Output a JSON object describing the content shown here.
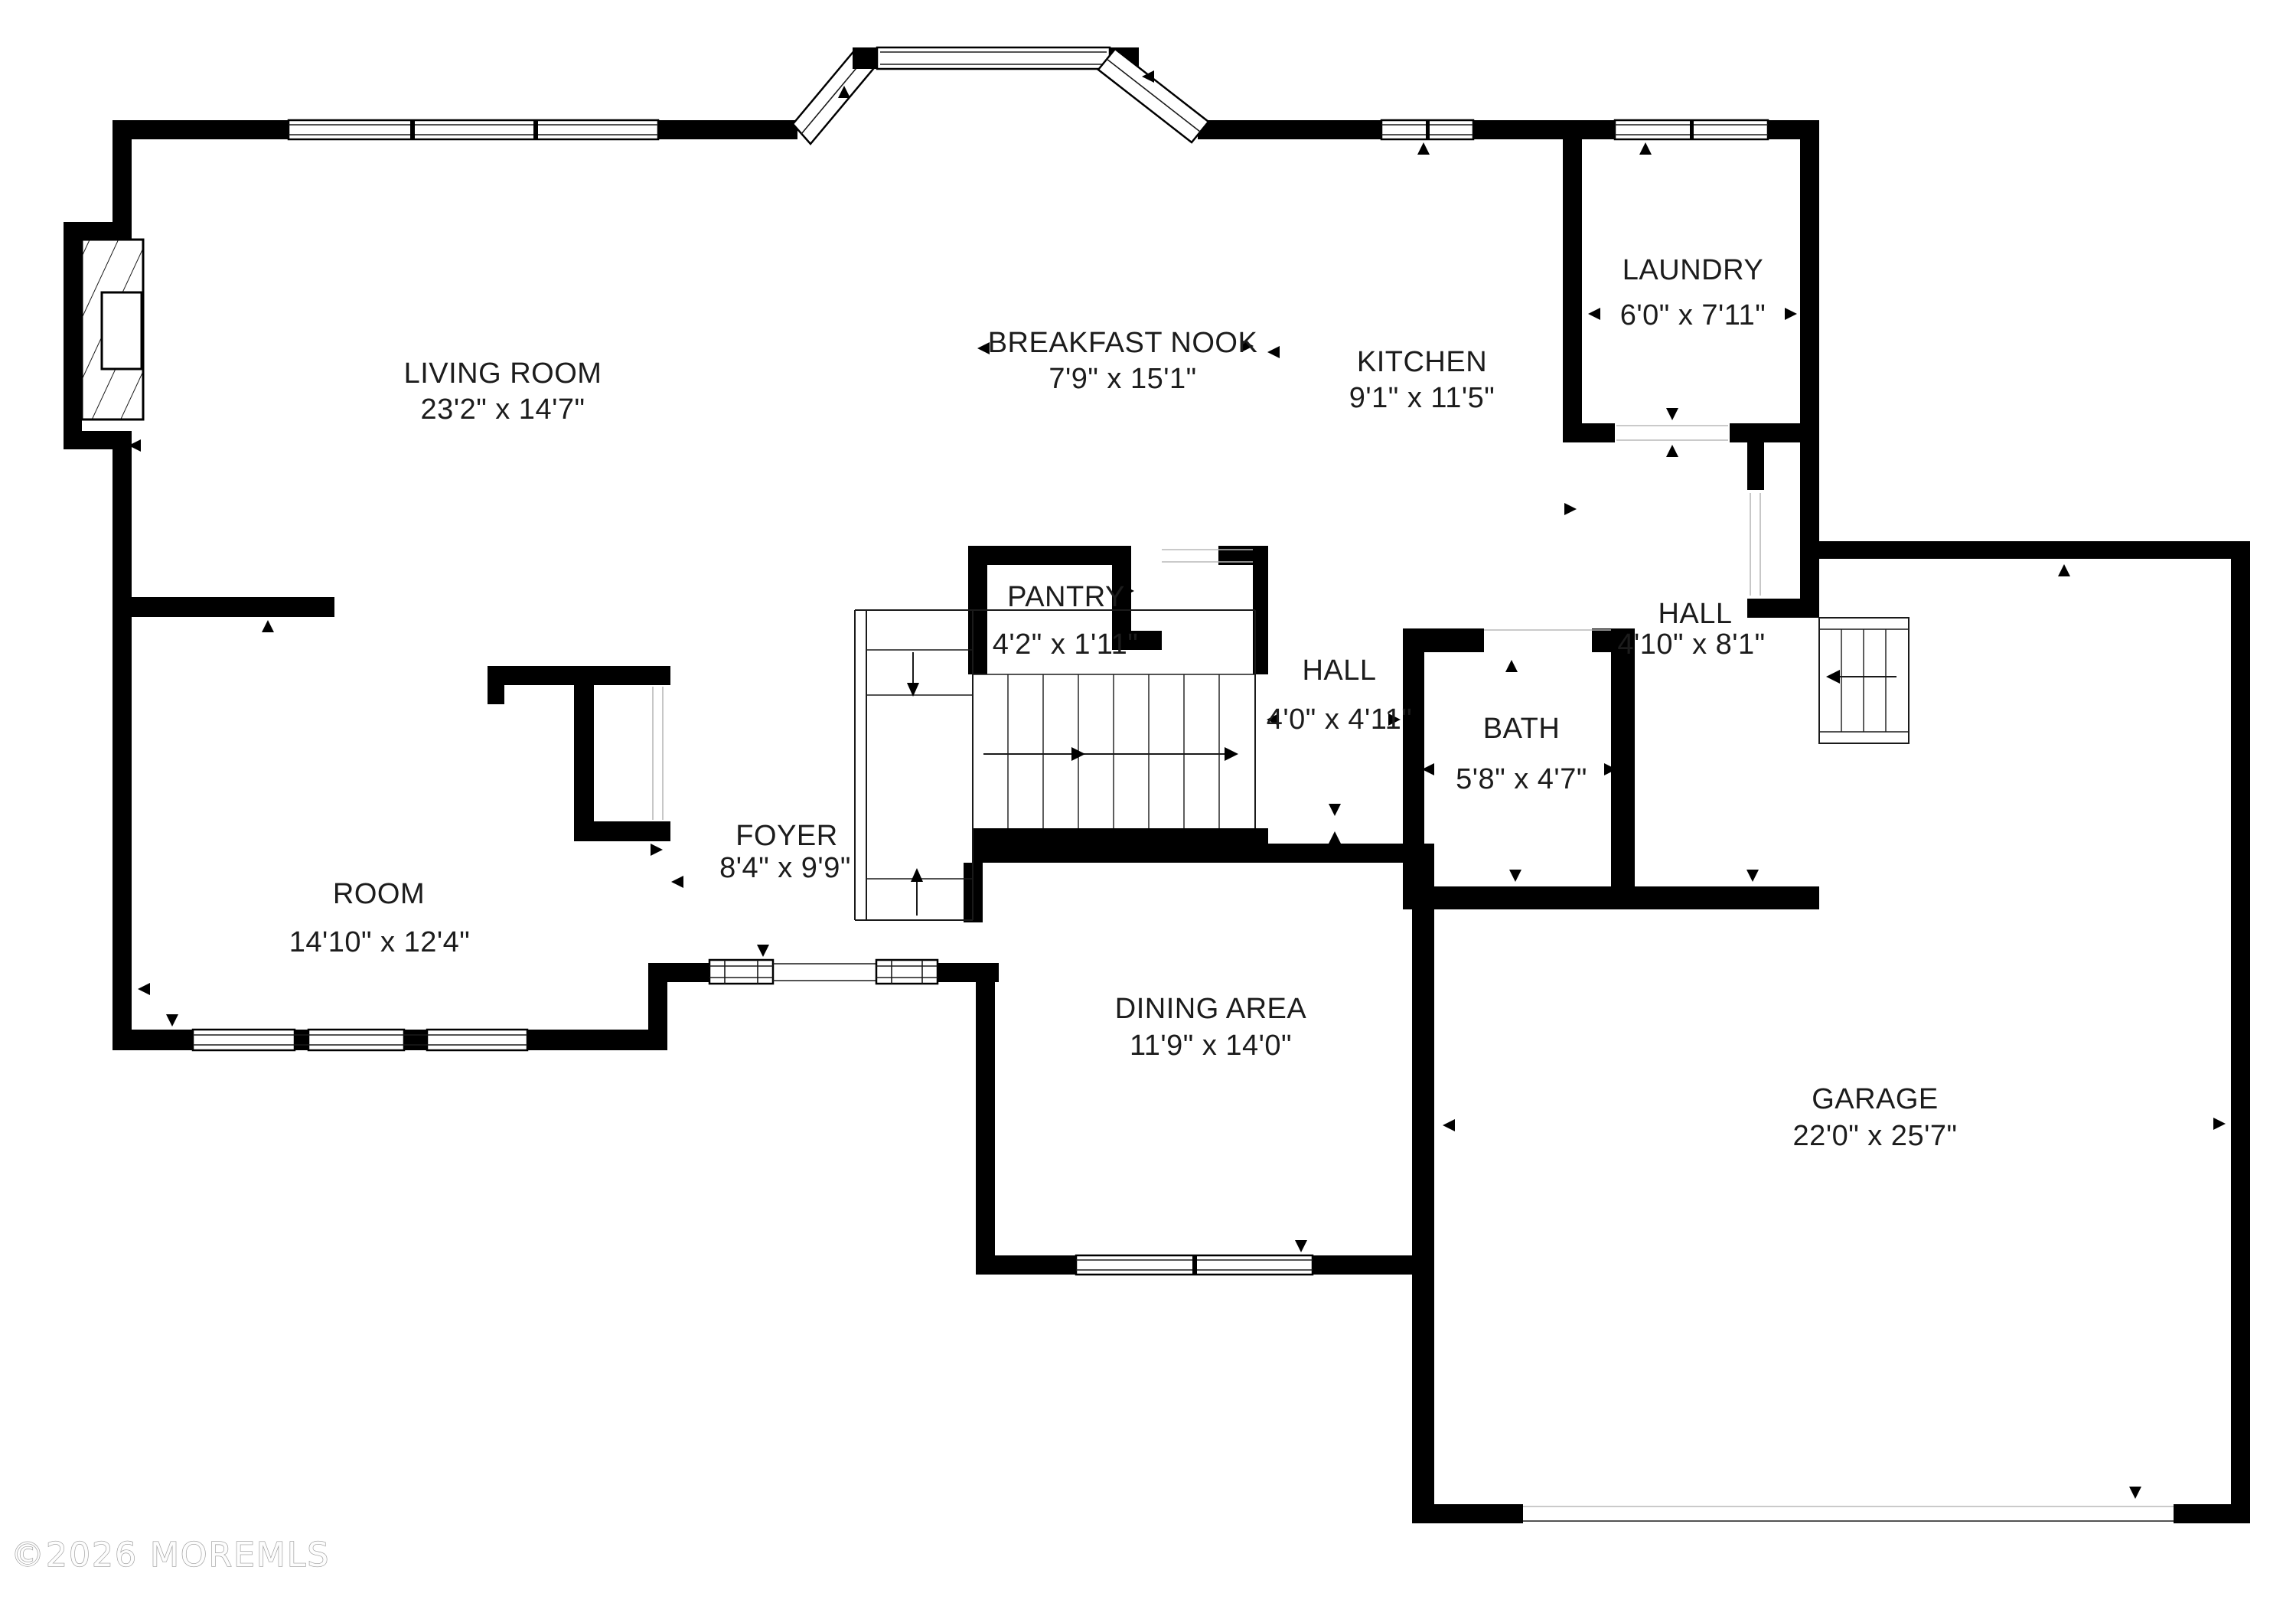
{
  "watermark": "©2026 MOREMLS",
  "rooms": [
    {
      "id": "living-room",
      "name": "LIVING ROOM",
      "dims": "23'2\" x 14'7\""
    },
    {
      "id": "breakfast-nook",
      "name": "BREAKFAST NOOK",
      "dims": "7'9\" x 15'1\""
    },
    {
      "id": "kitchen",
      "name": "KITCHEN",
      "dims": "9'1\" x 11'5\""
    },
    {
      "id": "laundry",
      "name": "LAUNDRY",
      "dims": "6'0\" x 7'11\""
    },
    {
      "id": "pantry",
      "name": "PANTRY",
      "dims": "4'2\" x 1'11\""
    },
    {
      "id": "hall-kitchen",
      "name": "HALL",
      "dims": "4'0\" x 4'11\""
    },
    {
      "id": "bath",
      "name": "BATH",
      "dims": "5'8\" x 4'7\""
    },
    {
      "id": "hall-rear",
      "name": "HALL",
      "dims": "4'10\" x 8'1\""
    },
    {
      "id": "room",
      "name": "ROOM",
      "dims": "14'10\" x 12'4\""
    },
    {
      "id": "foyer",
      "name": "FOYER",
      "dims": "8'4\" x 9'9\""
    },
    {
      "id": "dining-area",
      "name": "DINING AREA",
      "dims": "11'9\" x 14'0\""
    },
    {
      "id": "garage",
      "name": "GARAGE",
      "dims": "22'0\" x 25'7\""
    }
  ]
}
